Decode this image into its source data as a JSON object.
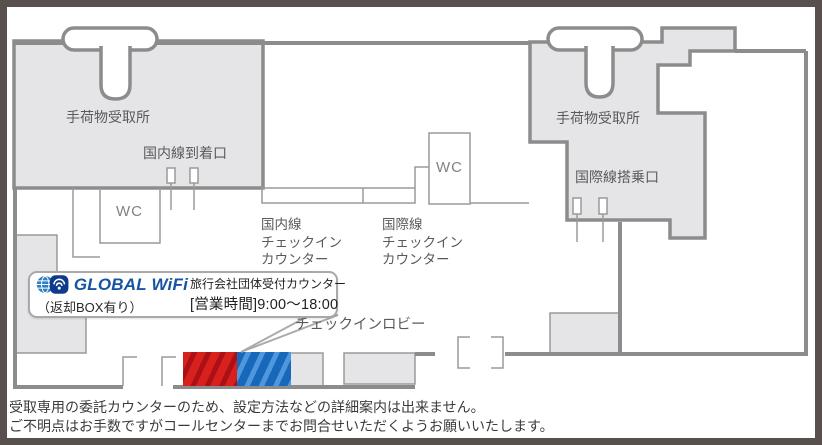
{
  "colors": {
    "building_fill": "#e5e5e7",
    "wall": "#8c8c8c",
    "thin_line": "#9a9a9a",
    "label_text": "#5a5a5a",
    "brand_blue": "#17549f",
    "wifi_icon_navy": "#0d3a8c",
    "globe_blue": "#2f80c3",
    "counter_red": "#d8201c",
    "counter_blue": "#1767ba",
    "frame": "#57504c"
  },
  "areas": {
    "baggage_claim_left": "手荷物受取所",
    "domestic_arrival_gate": "国内線到着口",
    "wc_left": "WC",
    "wc_center": "WC",
    "domestic_checkin_counter": "国内線\nチェックイン\nカウンター",
    "international_checkin_counter": "国際線\nチェックイン\nカウンター",
    "baggage_claim_right": "手荷物受取所",
    "international_boarding_gate": "国際線搭乗口",
    "checkin_lobby": "チェックインロビー"
  },
  "badge": {
    "brand": "GLOBAL WiFi",
    "return_box_note": "（返却BOX有り）",
    "counter_name": "旅行会社団体受付カウンター",
    "business_hours": "[営業時間]9:00～18:00"
  },
  "footnote": {
    "line1": "受取専用の委託カウンターのため、設定方法などの詳細案内は出来ません。",
    "line2": "ご不明点はお手数ですがコールセンターまでお問合せいただくようお願いいたします。"
  }
}
